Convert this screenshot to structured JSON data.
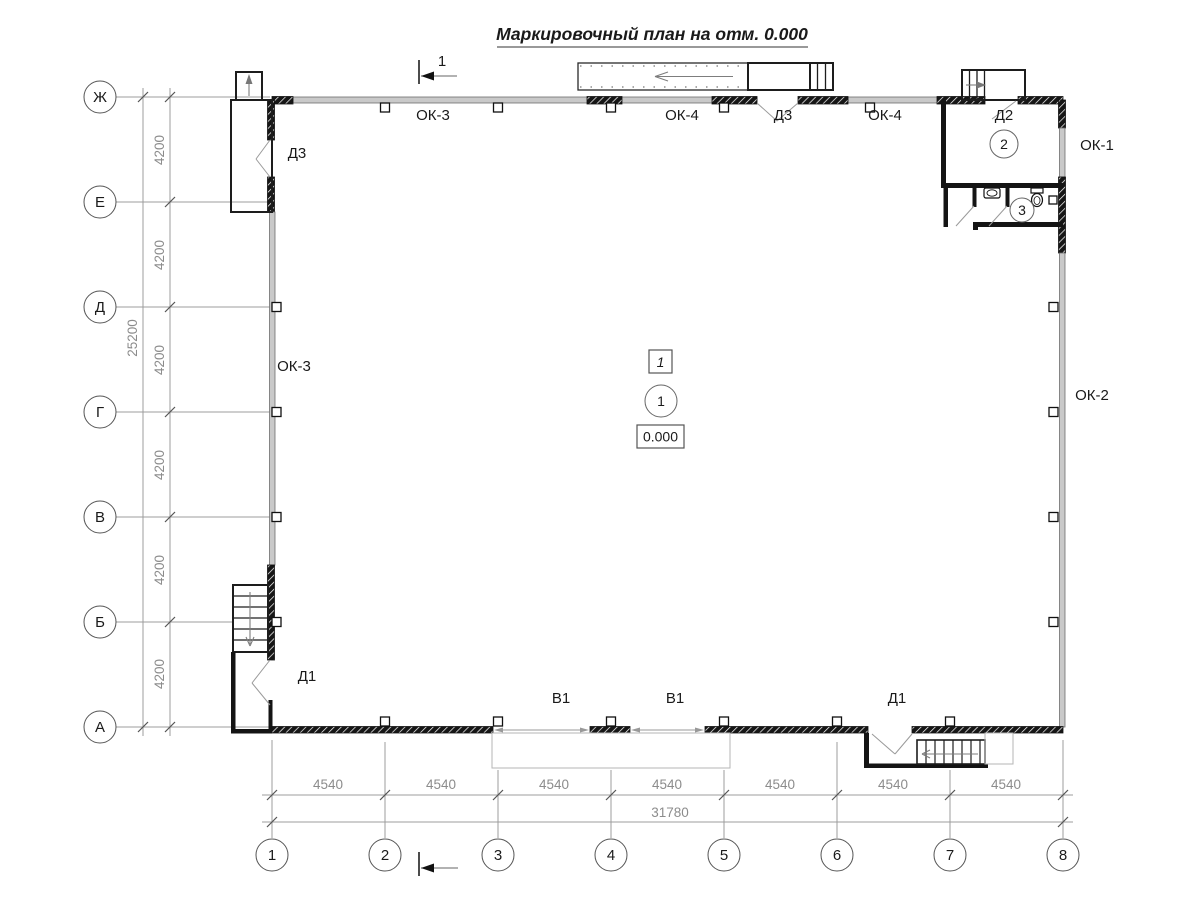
{
  "title": "Маркировочный план на отм. 0.000",
  "axis": {
    "rows": [
      "Ж",
      "Е",
      "Д",
      "Г",
      "В",
      "Б",
      "А"
    ],
    "cols": [
      "1",
      "2",
      "3",
      "4",
      "5",
      "6",
      "7",
      "8"
    ],
    "row_segment_dims": [
      "4200",
      "4200",
      "4200",
      "4200",
      "4200",
      "4200"
    ],
    "row_total_dim": "25200",
    "col_segment_dims": [
      "4540",
      "4540",
      "4540",
      "4540",
      "4540",
      "4540",
      "4540"
    ],
    "col_total_dim": "31780"
  },
  "marks": {
    "section_number": "1",
    "floor_type_marker": "1",
    "elevation": "0.000"
  },
  "rooms": {
    "r1": "1",
    "r2": "2",
    "r3": "3"
  },
  "openings": {
    "top_ok3": "ОК-3",
    "top_ok4_left": "ОК-4",
    "top_d3": "Д3",
    "top_ok4_right": "ОК-4",
    "top_d2": "Д2",
    "right_ok1": "ОК-1",
    "right_ok2": "ОК-2",
    "left_d3": "Д3",
    "left_ok3": "ОК-3",
    "left_d1": "Д1",
    "bottom_v1_left": "В1",
    "bottom_v1_right": "В1",
    "bottom_d1": "Д1"
  },
  "colors": {
    "wall": "#141414",
    "window_band": "#c9c9c9",
    "dimension": "#8c8c8c",
    "background": "#ffffff"
  }
}
